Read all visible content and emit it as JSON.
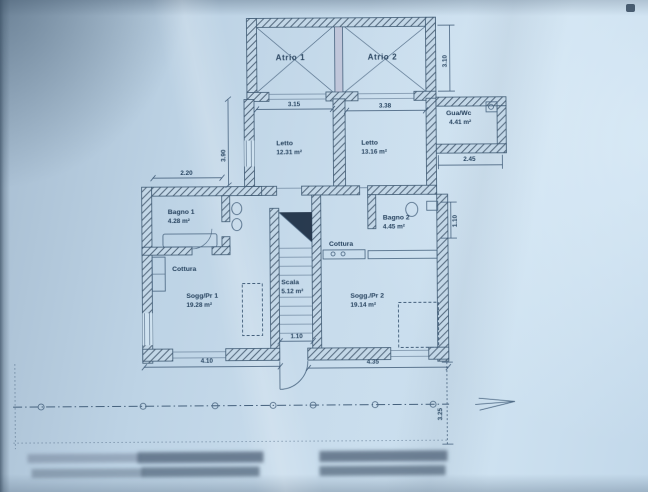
{
  "rooms": {
    "atrio1": {
      "name": "Atrio 1"
    },
    "atrio2": {
      "name": "Atrio 2"
    },
    "letto1": {
      "name": "Letto",
      "area": "12.31 m²"
    },
    "letto2": {
      "name": "Letto",
      "area": "13.16 m²"
    },
    "guawc": {
      "name": "Gua/Wc",
      "area": "4.41 m²"
    },
    "bagno1": {
      "name": "Bagno 1",
      "area": "4.28 m²"
    },
    "bagno2": {
      "name": "Bagno 2",
      "area": "4.45 m²"
    },
    "cottura_left": {
      "name": "Cottura"
    },
    "cottura_right": {
      "name": "Cottura"
    },
    "sogg1": {
      "name": "Sogg/Pr 1",
      "area": "19.28 m²"
    },
    "sogg2": {
      "name": "Sogg./Pr 2",
      "area": "19.14 m²"
    },
    "scala": {
      "name": "Scala",
      "area": "5.12 m²"
    }
  },
  "dimensions": {
    "letto1_width": "3.15",
    "letto2_width": "3.38",
    "left_height": "3.90",
    "atrio_height": "3.10",
    "bagno1_width": "2.20",
    "guawc_width": "2.45",
    "right_offset": "1.10",
    "stair_width": "1.10",
    "sogg1_width": "4.10",
    "sogg2_width": "4.35",
    "front_depth": "3.25"
  },
  "colors": {
    "paper": "#c8dcec",
    "ink": "#24435f",
    "wall_hatch": "#44596f"
  }
}
